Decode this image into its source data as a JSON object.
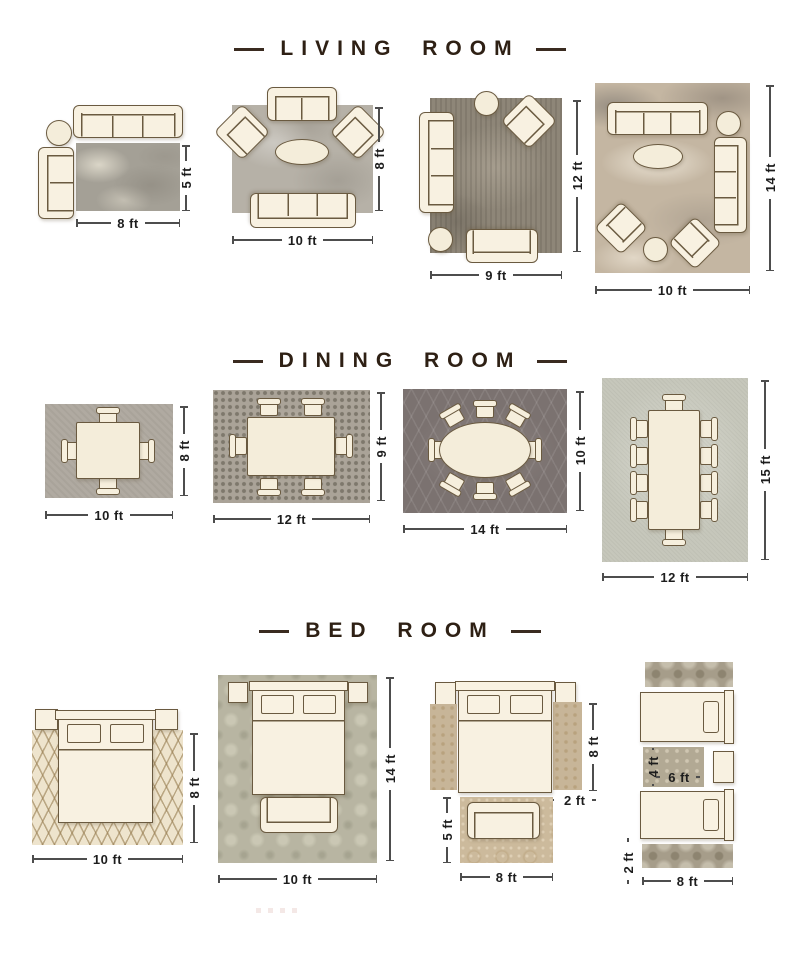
{
  "colors": {
    "furniture_fill": "#f8f1e1",
    "furniture_outline": "#6a5a40",
    "heading_text": "#2e2014",
    "dimension_text": "#1d1d1d"
  },
  "sections": [
    {
      "title": "LIVING ROOM",
      "layouts": [
        {
          "width": "8 ft",
          "height": "5 ft"
        },
        {
          "width": "10 ft",
          "height": "8 ft"
        },
        {
          "width": "9 ft",
          "height": "12 ft"
        },
        {
          "width": "10 ft",
          "height": "14 ft"
        }
      ]
    },
    {
      "title": "DINING ROOM",
      "layouts": [
        {
          "width": "10 ft",
          "height": "8 ft"
        },
        {
          "width": "12 ft",
          "height": "9 ft"
        },
        {
          "width": "14 ft",
          "height": "10 ft"
        },
        {
          "width": "12 ft",
          "height": "15 ft"
        }
      ]
    },
    {
      "title": "BED ROOM",
      "layouts": [
        {
          "width": "10 ft",
          "height": "8 ft"
        },
        {
          "width": "10 ft",
          "height": "14 ft"
        },
        {
          "runner_length": "8 ft",
          "runner_width": "2 ft",
          "foot_rug_height": "5 ft",
          "foot_rug_width": "8 ft"
        },
        {
          "between_rug_height": "4 ft",
          "between_rug_width": "6 ft",
          "runner_width": "2 ft",
          "runner_length": "8 ft"
        }
      ]
    }
  ]
}
